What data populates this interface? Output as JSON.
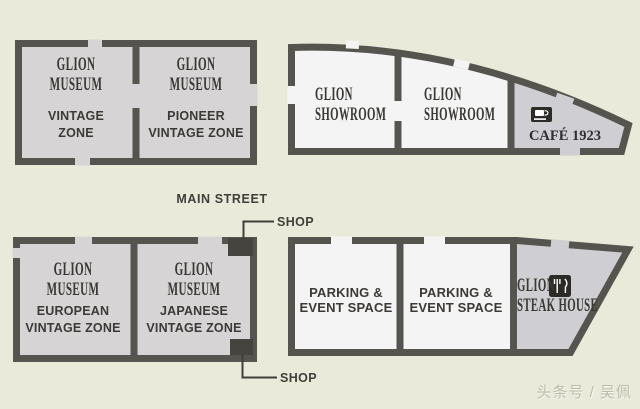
{
  "street": {
    "label": "MAIN STREET"
  },
  "shops": [
    {
      "label": "SHOP"
    },
    {
      "label": "SHOP"
    }
  ],
  "watermark": {
    "text": "头条号 / 吴佩"
  },
  "colors": {
    "background": "#e9ead9",
    "wall": "#56544e",
    "museum_room_fill": "#d6d4d5",
    "light_room_fill": "#f5f4f5",
    "gray_room_fill": "#cfced2",
    "shop_marker": "#45443e",
    "text": "#3b3a36",
    "watermark_text": "#bdbbaa"
  },
  "icons": {
    "cafe": "coffee-cup-icon",
    "steak_house": "fork-knife-icon"
  },
  "buildings": {
    "museum_north": {
      "rooms": [
        {
          "brand_lines": [
            "GLION",
            "MUSEUM"
          ],
          "zone_lines": [
            "VINTAGE",
            "ZONE"
          ]
        },
        {
          "brand_lines": [
            "GLION",
            "MUSEUM"
          ],
          "zone_lines": [
            "PIONEER",
            "VINTAGE ZONE"
          ]
        }
      ]
    },
    "showroom": {
      "rooms": [
        {
          "brand_lines": [
            "GLION",
            "SHOWROOM"
          ]
        },
        {
          "brand_lines": [
            "GLION",
            "SHOWROOM"
          ]
        }
      ],
      "cafe": {
        "label": "CAFÉ 1923"
      }
    },
    "museum_south": {
      "rooms": [
        {
          "brand_lines": [
            "GLION",
            "MUSEUM"
          ],
          "zone_lines": [
            "EUROPEAN",
            "VINTAGE ZONE"
          ]
        },
        {
          "brand_lines": [
            "GLION",
            "MUSEUM"
          ],
          "zone_lines": [
            "JAPANESE",
            "VINTAGE ZONE"
          ]
        }
      ]
    },
    "parking": {
      "rooms": [
        {
          "lines": [
            "PARKING &",
            "EVENT SPACE"
          ]
        },
        {
          "lines": [
            "PARKING &",
            "EVENT SPACE"
          ]
        }
      ],
      "steak_house": {
        "brand_line": "GLION",
        "name_line": "STEAK HOUSE"
      }
    }
  }
}
